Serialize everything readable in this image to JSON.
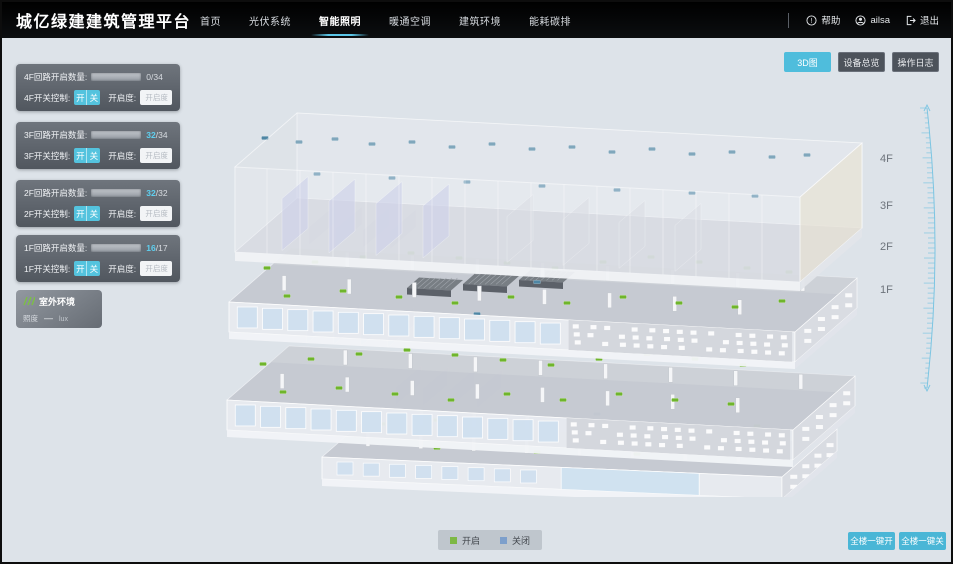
{
  "header": {
    "title": "城亿绿建建筑管理平台",
    "nav": [
      {
        "label": "首页"
      },
      {
        "label": "光伏系统"
      },
      {
        "label": "智能照明"
      },
      {
        "label": "暖通空调"
      },
      {
        "label": "建筑环境"
      },
      {
        "label": "能耗碳排"
      }
    ],
    "active_nav": "智能照明",
    "help_label": "帮助",
    "username": "ailsa",
    "logout_label": "退出"
  },
  "floor_panels": [
    {
      "count_label": "4F回路开启数量:",
      "open": "0",
      "total": "/34",
      "ratio": 0,
      "switch_label": "4F开关控制:",
      "on_label": "开",
      "off_label": "关",
      "dim_label": "开启度:",
      "dim_placeholder": "开启度",
      "percent": "%"
    },
    {
      "count_label": "3F回路开启数量:",
      "open": "32",
      "total": "/34",
      "ratio": 0.94,
      "switch_label": "3F开关控制:",
      "on_label": "开",
      "off_label": "关",
      "dim_label": "开启度:",
      "dim_placeholder": "开启度",
      "percent": "%"
    },
    {
      "count_label": "2F回路开启数量:",
      "open": "32",
      "total": "/32",
      "ratio": 1,
      "switch_label": "2F开关控制:",
      "on_label": "开",
      "off_label": "关",
      "dim_label": "开启度:",
      "dim_placeholder": "开启度",
      "percent": "%"
    },
    {
      "count_label": "1F回路开启数量:",
      "open": "16",
      "total": "/17",
      "ratio": 0.94,
      "switch_label": "1F开关控制:",
      "on_label": "开",
      "off_label": "关",
      "dim_label": "开启度:",
      "dim_placeholder": "开启度",
      "percent": "%"
    }
  ],
  "outdoor": {
    "title": "室外环境",
    "metric": "照度",
    "value": "—",
    "unit": "lux"
  },
  "view_buttons": [
    {
      "label": "3D图",
      "active": true
    },
    {
      "label": "设备总览",
      "active": false
    },
    {
      "label": "操作日志",
      "active": false
    }
  ],
  "floor_labels": [
    "4F",
    "3F",
    "2F",
    "1F"
  ],
  "legend": {
    "on_label": "开启",
    "off_label": "关闭",
    "on_color": "#7db844",
    "off_color": "#7d9fcb"
  },
  "bottom_actions": [
    {
      "label": "全楼一键开"
    },
    {
      "label": "全楼一键关"
    }
  ],
  "building": {
    "colors": {
      "on": "#6fb52c",
      "off": "#4e86a4"
    },
    "floors": [
      {
        "id": "f4",
        "on": [],
        "off": [
          [
            58,
            46
          ],
          [
            92,
            50
          ],
          [
            128,
            47
          ],
          [
            165,
            52
          ],
          [
            205,
            50
          ],
          [
            245,
            55
          ],
          [
            285,
            52
          ],
          [
            325,
            57
          ],
          [
            365,
            55
          ],
          [
            405,
            60
          ],
          [
            445,
            57
          ],
          [
            485,
            62
          ],
          [
            525,
            60
          ],
          [
            565,
            65
          ],
          [
            600,
            63
          ],
          [
            110,
            82
          ],
          [
            185,
            86
          ],
          [
            260,
            90
          ],
          [
            335,
            94
          ],
          [
            410,
            98
          ],
          [
            485,
            101
          ],
          [
            548,
            104
          ]
        ]
      },
      {
        "id": "f3",
        "on": [
          [
            60,
            176
          ],
          [
            108,
            170
          ],
          [
            156,
            165
          ],
          [
            204,
            161
          ],
          [
            252,
            166
          ],
          [
            300,
            171
          ],
          [
            348,
            176
          ],
          [
            396,
            170
          ],
          [
            444,
            165
          ],
          [
            492,
            170
          ],
          [
            540,
            176
          ],
          [
            582,
            180
          ],
          [
            80,
            204
          ],
          [
            136,
            199
          ],
          [
            192,
            205
          ],
          [
            248,
            211
          ],
          [
            304,
            205
          ],
          [
            360,
            211
          ],
          [
            416,
            205
          ],
          [
            472,
            211
          ],
          [
            528,
            215
          ],
          [
            575,
            209
          ]
        ],
        "off": [
          [
            330,
            190
          ],
          [
            270,
            222
          ]
        ]
      },
      {
        "id": "f2",
        "on": [
          [
            56,
            272
          ],
          [
            104,
            267
          ],
          [
            152,
            262
          ],
          [
            200,
            258
          ],
          [
            248,
            263
          ],
          [
            296,
            268
          ],
          [
            344,
            273
          ],
          [
            392,
            267
          ],
          [
            440,
            262
          ],
          [
            488,
            267
          ],
          [
            536,
            273
          ],
          [
            76,
            300
          ],
          [
            132,
            296
          ],
          [
            188,
            302
          ],
          [
            244,
            308
          ],
          [
            300,
            302
          ],
          [
            356,
            308
          ],
          [
            412,
            302
          ],
          [
            468,
            308
          ],
          [
            524,
            312
          ]
        ],
        "off": []
      },
      {
        "id": "f1",
        "on": [
          [
            175,
            332
          ],
          [
            230,
            328
          ],
          [
            285,
            334
          ],
          [
            340,
            330
          ],
          [
            395,
            336
          ],
          [
            450,
            332
          ],
          [
            505,
            338
          ],
          [
            550,
            334
          ],
          [
            230,
            356
          ],
          [
            330,
            360
          ],
          [
            430,
            362
          ],
          [
            510,
            358
          ]
        ],
        "off": [
          [
            390,
            322
          ]
        ]
      }
    ]
  }
}
